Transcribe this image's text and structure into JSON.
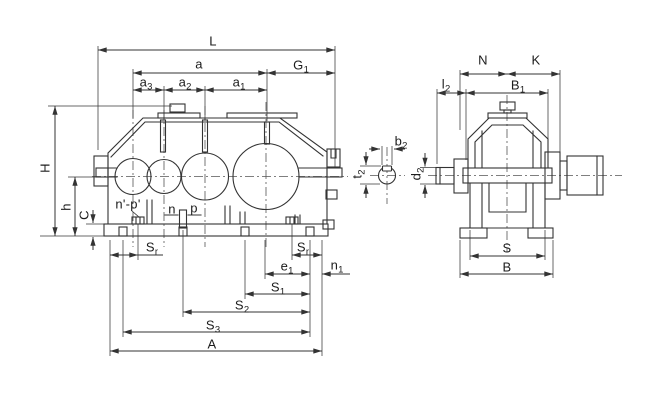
{
  "drawing": {
    "type": "technical-dimension-drawing",
    "views": [
      "side-elevation",
      "end-elevation",
      "shaft-key-section"
    ],
    "colors": {
      "line": "#333333",
      "centerline": "#555555",
      "background": "#ffffff",
      "label": "#1c1c1c"
    }
  },
  "labels": {
    "L": {
      "base": "L",
      "sub": ""
    },
    "a": {
      "base": "a",
      "sub": ""
    },
    "G1": {
      "base": "G",
      "sub": "1"
    },
    "a3": {
      "base": "a",
      "sub": "3"
    },
    "a2": {
      "base": "a",
      "sub": "2"
    },
    "a1": {
      "base": "a",
      "sub": "1"
    },
    "H": {
      "base": "H",
      "sub": ""
    },
    "h": {
      "base": "h",
      "sub": ""
    },
    "C": {
      "base": "C",
      "sub": ""
    },
    "np_prime": {
      "base": "n'-p'",
      "sub": ""
    },
    "n": {
      "base": "n",
      "sub": ""
    },
    "p": {
      "base": "p",
      "sub": ""
    },
    "Sr_left": {
      "base": "S",
      "sub": "r"
    },
    "Sr_right": {
      "base": "S",
      "sub": "r"
    },
    "e1": {
      "base": "e",
      "sub": "1"
    },
    "n1": {
      "base": "n",
      "sub": "1"
    },
    "S1": {
      "base": "S",
      "sub": "1"
    },
    "S2": {
      "base": "S",
      "sub": "2"
    },
    "S3": {
      "base": "S",
      "sub": "3"
    },
    "A": {
      "base": "A",
      "sub": ""
    },
    "b2": {
      "base": "b",
      "sub": "2"
    },
    "t2": {
      "base": "t",
      "sub": "2"
    },
    "d2": {
      "base": "d",
      "sub": "2"
    },
    "N": {
      "base": "N",
      "sub": ""
    },
    "K": {
      "base": "K",
      "sub": ""
    },
    "l2": {
      "base": "l",
      "sub": "2"
    },
    "B1": {
      "base": "B",
      "sub": "1"
    },
    "S": {
      "base": "S",
      "sub": ""
    },
    "B": {
      "base": "B",
      "sub": ""
    }
  }
}
